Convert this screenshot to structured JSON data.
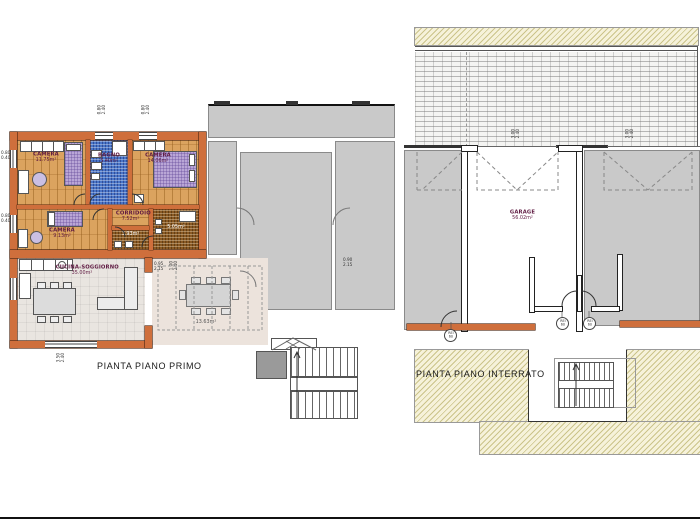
{
  "colors": {
    "wall_orange": "#cf6f3c",
    "wood": "#dba35f",
    "tile_blue": "#4a76c8",
    "tile_brown": "#8a5a24",
    "kfloor": "#e9e5e0",
    "terr": "#ece3dc",
    "gray": "#c9c9c9",
    "ground": "#f6f2da"
  },
  "primo": {
    "caption": "PIANTA PIANO PRIMO",
    "rooms": {
      "camera1": {
        "name": "CAMERA",
        "area": "11.75m²"
      },
      "bagno1": {
        "name": "BAGNO",
        "area": "5.40m²"
      },
      "camera2": {
        "name": "CAMERA",
        "area": "14.06m²"
      },
      "corridoio": {
        "name": "CORRIDOIO",
        "area": "7.52m²"
      },
      "camera3": {
        "name": "CAMERA",
        "area": "9.13m²"
      },
      "bagno2": {
        "name": "BAGNO",
        "area": "3.93m²"
      },
      "bagno3": {
        "name": "BAGNO",
        "area": "5.05m²"
      },
      "cucina": {
        "name": "CUCINA-SOGGIORNO",
        "area": "35.00m²"
      },
      "terrazza": {
        "area": "13.63m²"
      }
    },
    "dims": [
      {
        "a": "0.80",
        "b": "2.40"
      },
      {
        "a": "0.80",
        "b": "2.40"
      },
      {
        "a": "0.80",
        "b": "0.40"
      },
      {
        "a": "0.80",
        "b": "0.40"
      },
      {
        "a": "3.50",
        "b": "2.40"
      },
      {
        "a": "0.95",
        "b": "2.15"
      },
      {
        "a": "1.00",
        "b": "2.40"
      },
      {
        "a": "0.90",
        "b": "2.15"
      }
    ]
  },
  "interrato": {
    "caption": "PIANTA PIANO INTERRATO",
    "garage": {
      "name": "GARAGE",
      "area": "56.02m²"
    },
    "dims": [
      {
        "a": "3.00",
        "b": "2.40"
      },
      {
        "a": "3.00",
        "b": "2.40"
      }
    ],
    "rei": [
      {
        "l1": "REI",
        "l2": "60"
      },
      {
        "l1": "REI",
        "l2": "60"
      },
      {
        "l1": "REI",
        "l2": "60"
      }
    ]
  }
}
